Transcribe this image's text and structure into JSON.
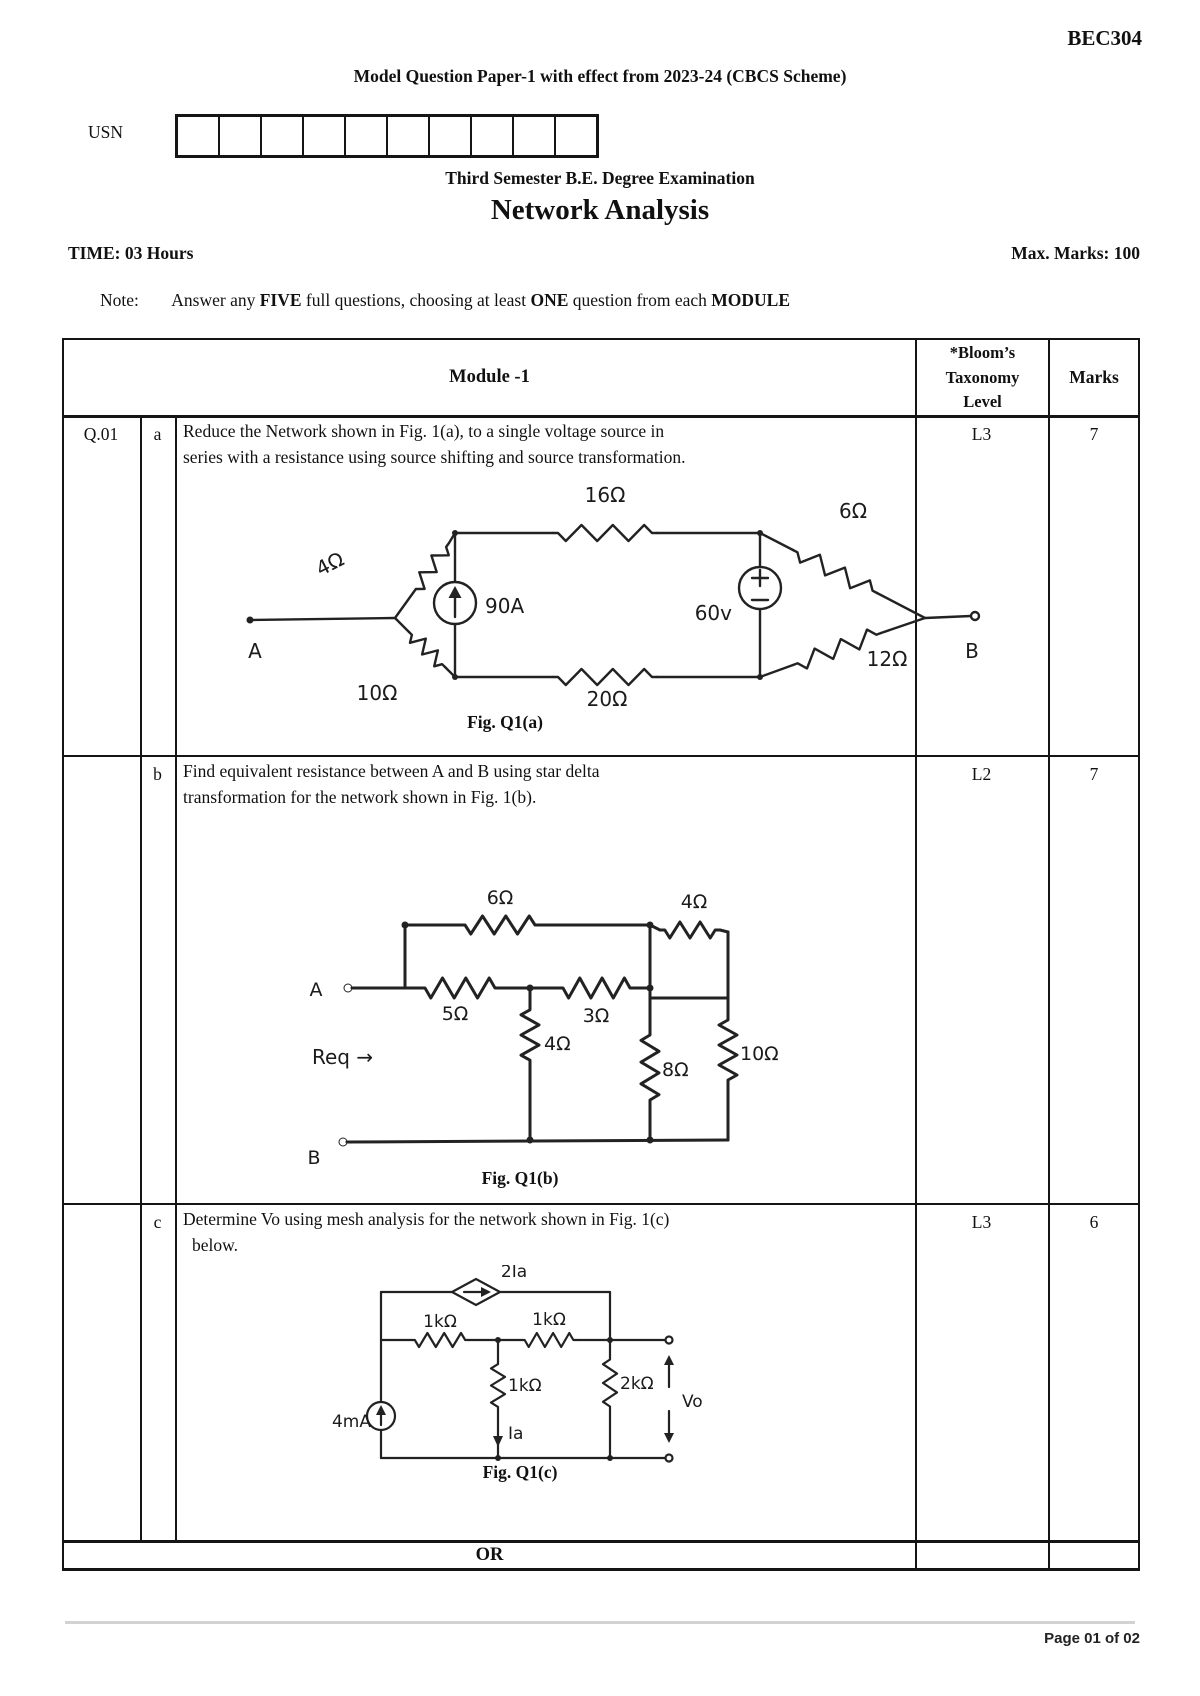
{
  "header": {
    "code": "BEC304",
    "subtitle": "Model Question Paper-1 with effect from 2023-24 (CBCS Scheme)",
    "usn_label": "USN",
    "usn_box_count": 10,
    "exam_line": "Third Semester B.E. Degree Examination",
    "course_title": "Network Analysis",
    "time": "TIME: 03 Hours",
    "max_marks": "Max. Marks: 100",
    "note": {
      "label": "Note:",
      "p1": "Answer any ",
      "b1": "FIVE",
      "p2": " full questions, choosing at least ",
      "b2": "ONE",
      "p3": " question from each ",
      "b3": "MODULE"
    }
  },
  "table": {
    "module_header": "Module -1",
    "bloom_header_l1": "*Bloom’s",
    "bloom_header_l2": "Taxonomy",
    "bloom_header_l3": "Level",
    "marks_header": "Marks",
    "qno": "Q.01",
    "rows": [
      {
        "part": "a",
        "line1": "Reduce the Network shown in Fig. 1(a), to a single voltage source in",
        "line2": "series with a resistance using source shifting and source transformation.",
        "caption": "Fig. Q1(a)",
        "level": "L3",
        "marks": "7"
      },
      {
        "part": "b",
        "line1": "Find equivalent resistance between A and B using star delta",
        "line2": "transformation for the network shown in Fig. 1(b).",
        "caption": "Fig. Q1(b)",
        "level": "L2",
        "marks": "7"
      },
      {
        "part": "c",
        "line1": "Determine Vo using mesh analysis for the network shown in Fig. 1(c)",
        "line2": "below.",
        "caption": "Fig. Q1(c)",
        "level": "L3",
        "marks": "6"
      }
    ],
    "or_label": "OR"
  },
  "figures": {
    "a": {
      "r4": "4Ω",
      "r16": "16Ω",
      "r6": "6Ω",
      "r10": "10Ω",
      "r20": "20Ω",
      "r12": "12Ω",
      "i_src": "90A",
      "v_src": "60v",
      "node_a": "A",
      "node_b": "B"
    },
    "b": {
      "r6": "6Ω",
      "r4_top": "4Ω",
      "r5": "5Ω",
      "r3": "3Ω",
      "r4_mid": "4Ω",
      "r8": "8Ω",
      "r10": "10Ω",
      "node_a": "A",
      "node_b": "B",
      "req": "Req →"
    },
    "c": {
      "dep_src": "2Ia",
      "r1k_a": "1kΩ",
      "r1k_b": "1kΩ",
      "r1k_c": "1kΩ",
      "i_a": "Ia",
      "r2k": "2kΩ",
      "i_src": "4mA",
      "v_out": "Vo"
    }
  },
  "footer": {
    "page": "Page 01 of 02"
  }
}
